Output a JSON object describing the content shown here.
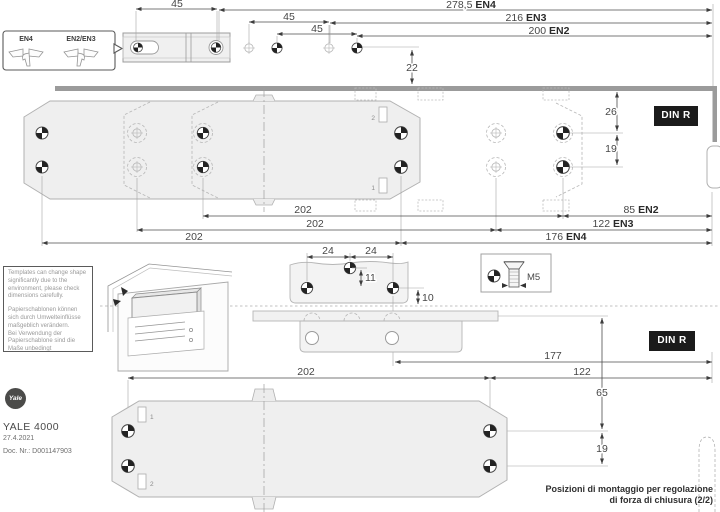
{
  "title_block": {
    "brand": "Yale",
    "product": "YALE 4000",
    "date": "27.4.2021",
    "doc_nr": "Doc. Nr.: D001147903"
  },
  "caption": {
    "line1": "Posizioni di montaggio per regolazione",
    "line2": "di forza di chiusura (2/2)"
  },
  "badge": {
    "din": "DIN R"
  },
  "callout": {
    "left": "EN4",
    "right": "EN2/EN3"
  },
  "legend": {
    "screw_size": "M5"
  },
  "notes": {
    "en": "Templates can change shape significantly due to the environment, please check dimensions carefully.",
    "de1": "Papierschablonen können sich durch Umwelteinflüsse maßgeblich verändern.",
    "de2": "Bei Verwendung der Papierschablone sind die Maße unbedingt nachzuprüfen."
  },
  "hole_labels": {
    "top_body_upper": "2",
    "top_body_lower": "1",
    "bottom_body_upper": "1",
    "bottom_body_lower": "2"
  },
  "dims": {
    "arm_hole_spacing_1": "45",
    "hole_spacing_2": "45",
    "hole_spacing_3": "45",
    "top_offset": "22",
    "overall_en4": "278,5",
    "overall_en4_std": "EN4",
    "overall_en3": "216",
    "overall_en3_std": "EN3",
    "overall_en2": "200",
    "overall_en2_std": "EN2",
    "frame_to_hole": "26",
    "hole_row_gap_top": "19",
    "edge_en2": "85",
    "edge_en2_std": "EN2",
    "edge_en3": "122",
    "edge_en3_std": "EN3",
    "edge_en4": "176",
    "edge_en4_std": "EN4",
    "body_length_1": "202",
    "body_length_2": "202",
    "body_length_3": "202",
    "rail_hole_spacing_1": "24",
    "rail_hole_spacing_2": "24",
    "rail_hole_offset": "11",
    "rail_edge_offset": "10",
    "rail_to_edge": "177",
    "body_to_edge": "122",
    "rail_to_body": "65",
    "hole_row_gap_bottom": "19",
    "body_length_bottom": "202"
  }
}
